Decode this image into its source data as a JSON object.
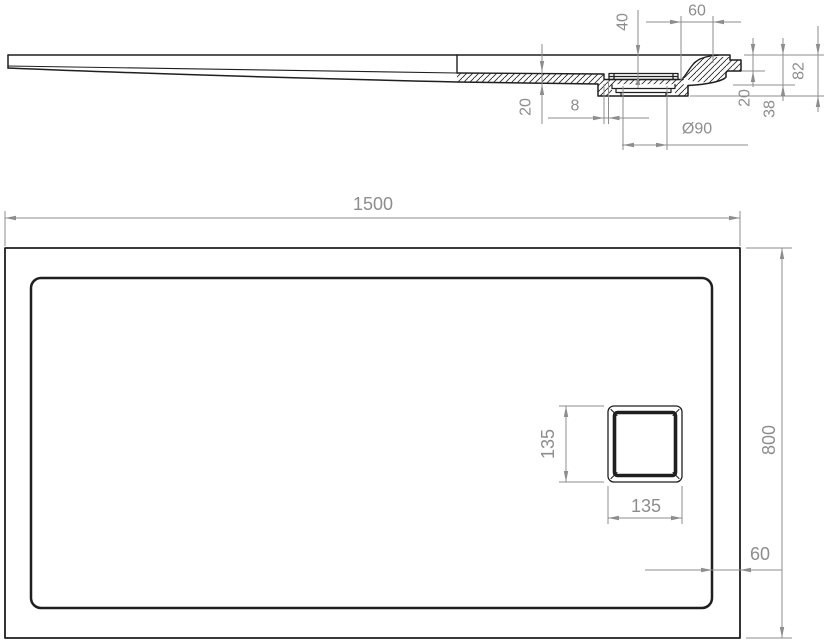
{
  "drawing_type": "shower-tray technical drawing",
  "section_view": {
    "dims": {
      "recess_depth": "40",
      "drain_to_edge": "60",
      "floor_thickness": "20",
      "gap": "8",
      "drain_diameter": "Ø90",
      "rim_drop": "20",
      "edge_height": "38",
      "total_height": "82"
    }
  },
  "plan_view": {
    "dims": {
      "length": "1500",
      "width": "800",
      "drain_width": "135",
      "drain_height": "135",
      "drain_edge_offset": "60"
    }
  },
  "colors": {
    "outline": "#1f1f1f",
    "dimension": "#8d8d8d",
    "background": "#ffffff"
  }
}
